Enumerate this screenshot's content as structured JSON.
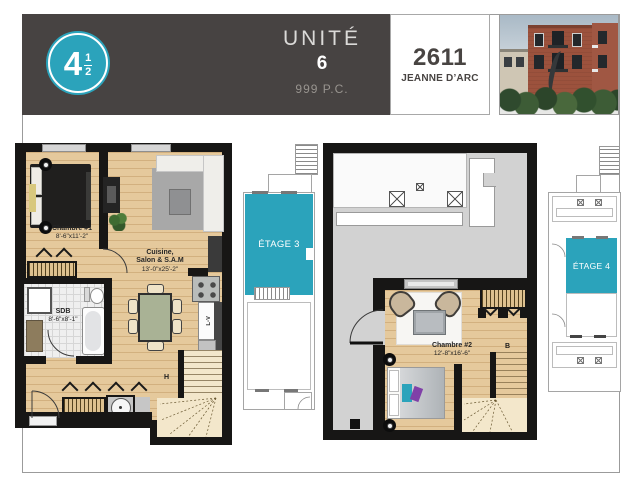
{
  "header": {
    "badge_whole": "4",
    "badge_num": "1",
    "badge_den": "2",
    "unit_label": "UNITÉ",
    "unit_number": "6",
    "unit_area": "999 P.C.",
    "address_number": "2611",
    "address_street": "JEANNE D’ARC"
  },
  "floor3": {
    "chambre1_name": "Chambre #1",
    "chambre1_dims": "8'-6\"x11'-2\"",
    "cuisine_line1": "Cuisine,",
    "cuisine_line2": "Salon & S.A.M",
    "cuisine_dims": "13'-0\"x25'-2\"",
    "sdb_name": "SDB",
    "sdb_dims": "8'-6\"x8'-1\"",
    "dishwasher_label": "L-V",
    "stairs_up_label": "H",
    "keyplan_label": "ÉTAGE 3"
  },
  "floor4": {
    "chambre2_name": "Chambre #2",
    "chambre2_dims": "12'-8\"x16'-6\"",
    "stairs_down_label": "B",
    "keyplan_label": "ÉTAGE 4"
  },
  "colors": {
    "accent_teal": "#2ba3bb",
    "header_dark": "#474342",
    "wall_black": "#171615",
    "wood_floor": "#e5c99c",
    "terrace_gray": "#d2d2d2",
    "stair_cream": "#f3e7cb"
  }
}
